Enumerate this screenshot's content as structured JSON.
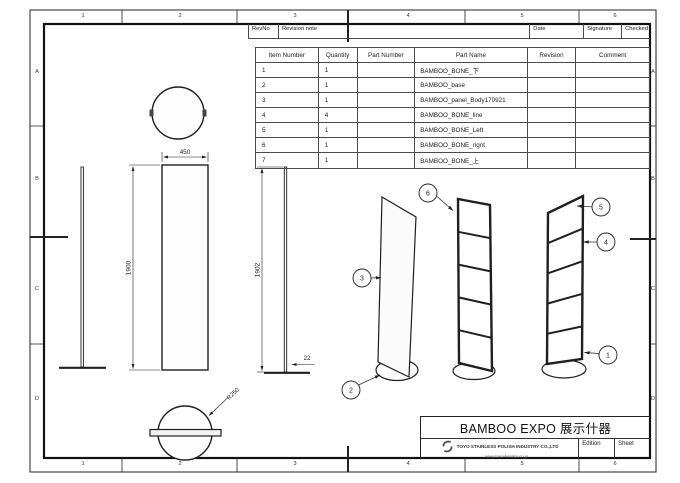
{
  "grid": {
    "top": [
      "1",
      "2",
      "3",
      "4",
      "5",
      "6"
    ],
    "bottom": [
      "1",
      "2",
      "3",
      "4",
      "5",
      "6"
    ],
    "left": [
      "A",
      "B",
      "C",
      "D"
    ],
    "right": [
      "A",
      "B",
      "C",
      "D"
    ]
  },
  "revision_table": {
    "rev_no": "RevNo",
    "note": "Revision note",
    "date": "Date",
    "signature": "Signature",
    "checked": "Checked"
  },
  "parts_table": {
    "headers": {
      "item": "Item Number",
      "qty": "Quantity",
      "part_number": "Part Number",
      "part_name": "Part Name",
      "revision": "Revision",
      "comment": "Comment"
    },
    "rows": [
      {
        "item": "1",
        "qty": "1",
        "part_number": "",
        "part_name": "BAMBOO_BONE_下",
        "revision": "",
        "comment": ""
      },
      {
        "item": "2",
        "qty": "1",
        "part_number": "",
        "part_name": "BAMBOO_base",
        "revision": "",
        "comment": ""
      },
      {
        "item": "3",
        "qty": "1",
        "part_number": "",
        "part_name": "BAMBOO_panel_Body170921",
        "revision": "",
        "comment": ""
      },
      {
        "item": "4",
        "qty": "4",
        "part_number": "",
        "part_name": "BAMBOO_BONE_line",
        "revision": "",
        "comment": ""
      },
      {
        "item": "5",
        "qty": "1",
        "part_number": "",
        "part_name": "BAMBOO_BONE_Left",
        "revision": "",
        "comment": ""
      },
      {
        "item": "6",
        "qty": "1",
        "part_number": "",
        "part_name": "BAMBOO_BONE_rignt",
        "revision": "",
        "comment": ""
      },
      {
        "item": "7",
        "qty": "1",
        "part_number": "",
        "part_name": "BAMBOO_BONE_上",
        "revision": "",
        "comment": ""
      }
    ]
  },
  "dimensions": {
    "panel_width": "450",
    "panel_height": "1900",
    "overall_height": "1902",
    "base_thickness": "22",
    "base_radius": "R250"
  },
  "balloons": {
    "1": "1",
    "2": "2",
    "3": "3",
    "4": "4",
    "5": "5",
    "6": "6"
  },
  "title_block": {
    "title": "BAMBOO EXPO 展示什器",
    "company": "TOYO STAINLESS POLISH INDUSTRY CO.,LTD",
    "website": "www.toyo-kenma.co.jp",
    "edition_label": "Edition",
    "sheet_label": "Sheet"
  },
  "colors": {
    "drawing_line": "#1f1f1f",
    "table_line": "#4a4a4a",
    "text": "#1a1a1a",
    "background": "#ffffff"
  }
}
